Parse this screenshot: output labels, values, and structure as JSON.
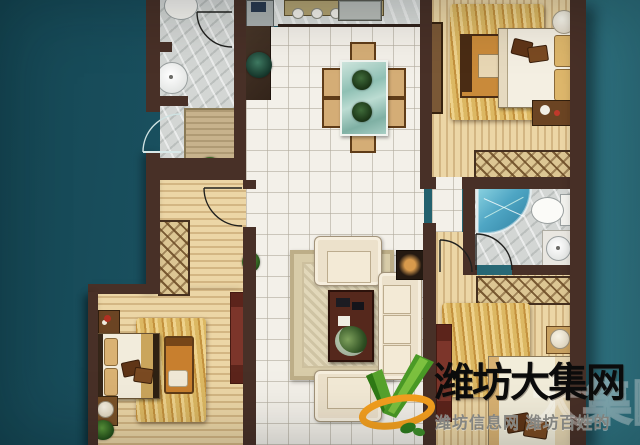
{
  "watermark": {
    "title": "潍坊大集网",
    "subtitle": "潍坊信息网 潍坊百姓的",
    "ghost_text": "大集网",
    "title_color": "#0c0c0c",
    "subtitle_color": "#8f8f8a"
  },
  "logo": {
    "name": "weifang-daji-logo",
    "green": "#4a9a26",
    "green_dark": "#2f7a15",
    "orange": "#f5a01f"
  },
  "palette": {
    "background_teal_left": "#154754",
    "background_teal_right": "#317684",
    "wall_brown": "#483027",
    "wood_floor": "#ecd6a6",
    "tile_floor": "#f3f0e9",
    "stone_floor": "#d3d6d4",
    "rug_gold": "#eed28c",
    "living_rug_beige": "#d8cba8",
    "dining_table_teal": "#8fc0b4",
    "shower_blue": "#4fa6c4",
    "tv_cabinet_red": "#7c352a",
    "sofa_cream": "#ece1cb"
  }
}
